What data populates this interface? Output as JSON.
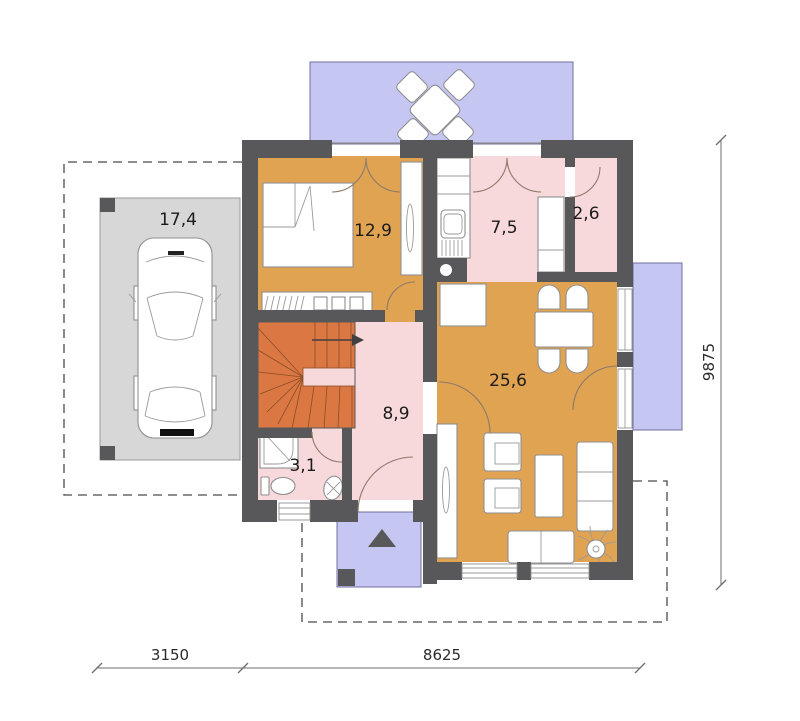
{
  "floor_plan": {
    "type": "architectural-floor-plan-ground-floor",
    "rooms": [
      {
        "id": "carport",
        "area": "17,4"
      },
      {
        "id": "bedroom",
        "area": "12,9"
      },
      {
        "id": "kitchen",
        "area": "7,5"
      },
      {
        "id": "pantry",
        "area": "2,6"
      },
      {
        "id": "living-dining",
        "area": "25,6"
      },
      {
        "id": "hall-stairs",
        "area": "8,9"
      },
      {
        "id": "bathroom",
        "area": "3,1"
      }
    ],
    "dimensions": {
      "bottom": [
        {
          "label": "3150"
        },
        {
          "label": "8625"
        }
      ],
      "right": {
        "label": "9875"
      }
    },
    "colors": {
      "wall": "#58585A",
      "warm_floor": "#E0A351",
      "light_floor": "#F8D9DB",
      "stairs": "#DB7742",
      "terrace": "#C6C6F2",
      "carport": "#D7D7D7"
    }
  }
}
